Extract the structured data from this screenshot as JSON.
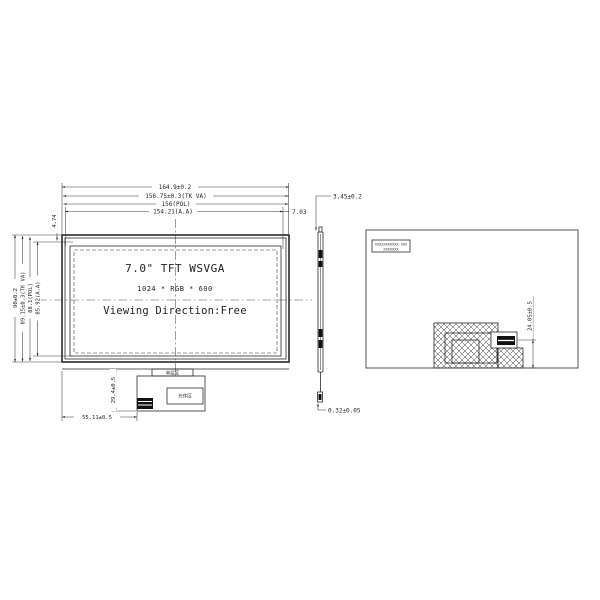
{
  "front": {
    "title": "7.0\" TFT WSVGA",
    "resolution": "1024 * RGB * 600",
    "viewing_direction": "Viewing Direction:Free",
    "dim_width_outline": "164.9±0.2",
    "dim_width_va": "156.75±0.3(TK VA)",
    "dim_width_pol": "156(POL)",
    "dim_width_aa": "154.21(A.A)",
    "dim_aa_right_offset": "7.03",
    "dim_aa_top_offset": "4.74",
    "dim_height_outline": "90±0.2",
    "dim_height_va": "89.15±0.3(TK VA)",
    "dim_height_pol": "88.1(POL)",
    "dim_height_aa": "85.92(A.A)"
  },
  "fpc": {
    "single_layer_label": "单层区",
    "component_area_label": "元件区",
    "dim_width": "55.11±0.5",
    "dim_height": "29.4±0.5"
  },
  "side": {
    "dim_thickness": "3.45±0.2",
    "dim_fpc_thickness": "0.32±0.05"
  },
  "back": {
    "label_line1": "XXXXXXXXXXX-XXX",
    "label_line2": "XXXXXXX",
    "dim_connector_offset": "24.05±0.5"
  }
}
